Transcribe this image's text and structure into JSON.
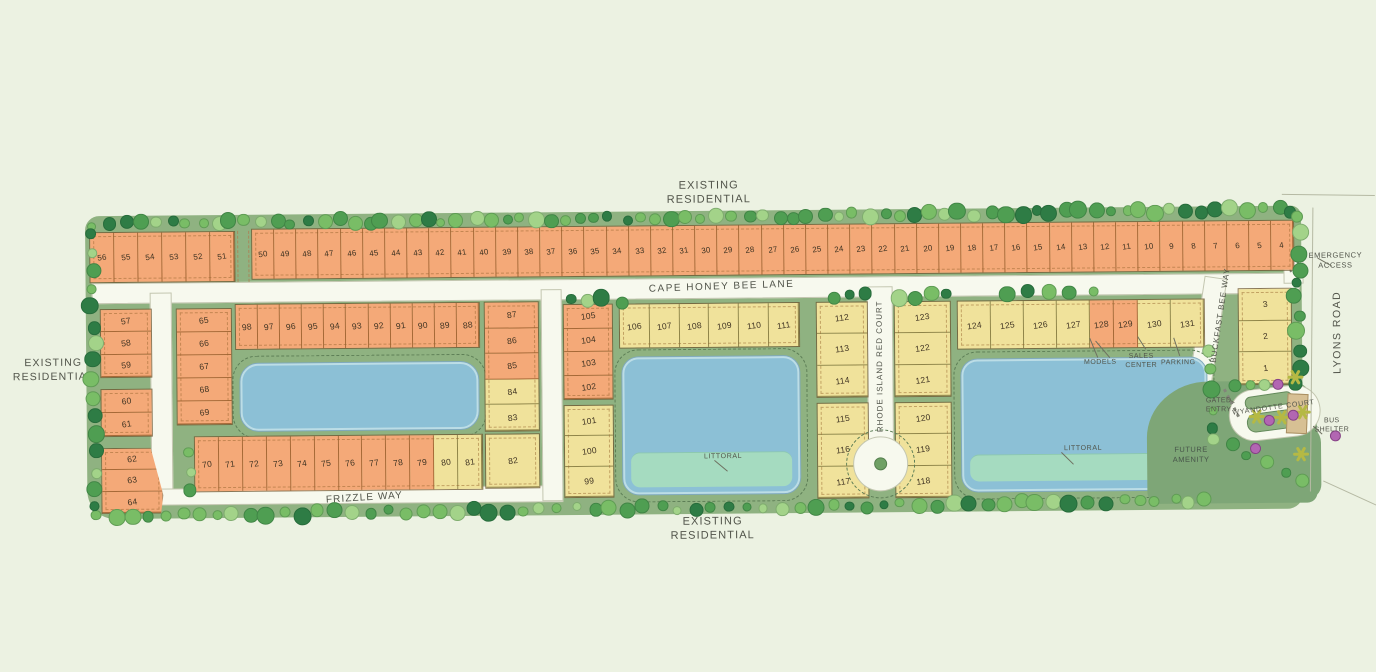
{
  "palette": {
    "bg": "#ecf2e2",
    "site_green": "#8fb281",
    "amenity_green": "#7ea677",
    "road": "#f7f9ee",
    "road_edge": "#c3c6b0",
    "lot_orange": "#f4a978",
    "lot_yellow": "#f0e29b",
    "pond_blue": "#8cc0d6",
    "pond_rim": "#bcdde6",
    "littoral_green": "#a5dbc0",
    "tree_dark": "#2e7c45",
    "tree_mid": "#4f9e52",
    "tree_light": "#79bd66",
    "tree_pale": "#a3d389",
    "shrub_purple": "#b266b2",
    "palm_yellow": "#b5b944",
    "label_text": "#51544a",
    "number_text": "#3f3322",
    "bus_shelter_tan": "#d7c094"
  },
  "labels": {
    "existing_residential_top": "EXISTING RESIDENTIAL",
    "existing_residential_left": "EXISTING RESIDENTIAL",
    "existing_residential_bottom": "EXISTING RESIDENTIAL",
    "emergency_access": "EMERGENCY ACCESS",
    "models": "MODELS",
    "sales_center": "SALES CENTER",
    "parking": "PARKING",
    "littoral_mid": "LITTORAL",
    "littoral_east": "LITTORAL",
    "gated_entry": "GATED ENTRY",
    "bus_shelter": "BUS SHELTER",
    "future_amenity": "FUTURE AMENITY",
    "lyons_road": "LYONS ROAD"
  },
  "streets": {
    "cape_honey_bee_lane": "CAPE HONEY BEE LANE",
    "frizzle_way": "FRIZZLE WAY",
    "rhode_island_red_court": "RHODE ISLAND RED COURT",
    "buckfast_bee_way": "BUCKFAST BEE WAY",
    "wyandotte_court": "WYANDOTTE COURT"
  },
  "blocks": {
    "top_west": {
      "segments": [
        {
          "type": "orange",
          "lots": [
            56,
            55,
            54,
            53,
            52,
            51
          ]
        }
      ]
    },
    "top_main": {
      "segments": [
        {
          "type": "orange",
          "lots": [
            50,
            49,
            48,
            47,
            46,
            45,
            44,
            43,
            42,
            41,
            40,
            39,
            38,
            37,
            36,
            35,
            34,
            33,
            32,
            31,
            30,
            29,
            28,
            27,
            26,
            25,
            24,
            23,
            22,
            21,
            20,
            19,
            18,
            17,
            16,
            15,
            14,
            13,
            12,
            11,
            10,
            9,
            8,
            7,
            6,
            5,
            4
          ]
        }
      ]
    },
    "west_a": {
      "segments": [
        {
          "type": "orange",
          "lots": [
            57,
            58,
            59
          ]
        }
      ]
    },
    "west_b": {
      "segments": [
        {
          "type": "orange",
          "lots": [
            60,
            61
          ]
        }
      ]
    },
    "west_c": {
      "segments": [
        {
          "type": "orange",
          "lots": [
            62,
            63,
            64
          ]
        }
      ]
    },
    "col_65": {
      "segments": [
        {
          "type": "orange",
          "lots": [
            65,
            66,
            67,
            68,
            69
          ]
        }
      ]
    },
    "row_98": {
      "segments": [
        {
          "type": "orange",
          "lots": [
            98,
            97,
            96,
            95,
            94,
            93,
            92,
            91,
            90,
            89,
            88
          ]
        }
      ]
    },
    "col_87": {
      "segments": [
        {
          "type": "orange",
          "lots": [
            87,
            86,
            85
          ]
        },
        {
          "type": "yellow",
          "lots": [
            84,
            83
          ]
        }
      ]
    },
    "row_70": {
      "segments": [
        {
          "type": "orange",
          "lots": [
            70,
            71,
            72,
            73,
            74,
            75,
            76,
            77,
            78,
            79
          ]
        },
        {
          "type": "yellow",
          "lots": [
            80,
            81
          ]
        }
      ]
    },
    "lot_82": {
      "segments": [
        {
          "type": "yellow",
          "lots": [
            82
          ]
        }
      ]
    },
    "col_105": {
      "segments": [
        {
          "type": "orange",
          "lots": [
            105,
            104,
            103,
            102
          ]
        }
      ]
    },
    "col_101": {
      "segments": [
        {
          "type": "yellow",
          "lots": [
            101,
            100,
            99
          ]
        }
      ]
    },
    "row_106": {
      "segments": [
        {
          "type": "yellow",
          "lots": [
            106,
            107,
            108,
            109,
            110,
            111
          ]
        }
      ]
    },
    "col_112": {
      "segments": [
        {
          "type": "yellow",
          "lots": [
            112,
            113,
            114
          ]
        }
      ]
    },
    "col_115": {
      "segments": [
        {
          "type": "yellow",
          "lots": [
            115,
            116,
            117
          ]
        }
      ]
    },
    "col_123": {
      "segments": [
        {
          "type": "yellow",
          "lots": [
            123,
            122,
            121
          ]
        }
      ]
    },
    "col_120": {
      "segments": [
        {
          "type": "yellow",
          "lots": [
            120,
            119,
            118
          ]
        }
      ]
    },
    "row_124": {
      "segments": [
        {
          "type": "yellow",
          "lots": [
            124,
            125,
            126,
            127
          ]
        },
        {
          "type": "orange",
          "lots": [
            128,
            129
          ],
          "flex": 0.72
        },
        {
          "type": "yellow",
          "lots": [
            130,
            131
          ]
        }
      ]
    },
    "col_321": {
      "segments": [
        {
          "type": "yellow",
          "lots": [
            3,
            2,
            1
          ]
        }
      ]
    }
  }
}
